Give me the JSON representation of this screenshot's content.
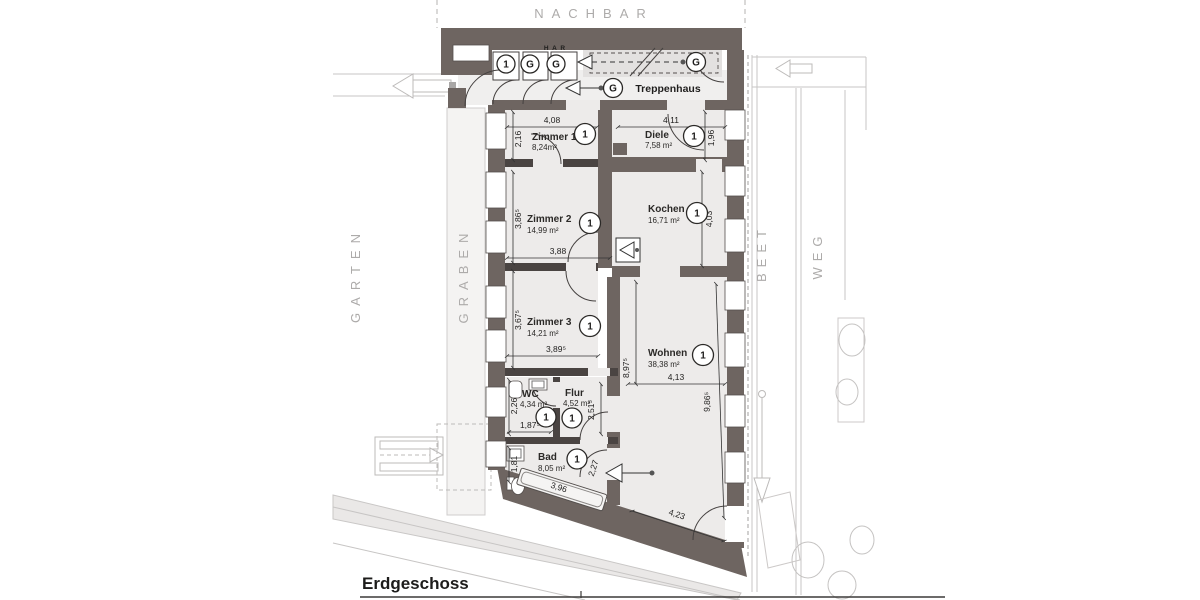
{
  "surroundings": {
    "neighbor_label": "NACHBAR",
    "garden_label": "GARTEN",
    "trench_label": "GRABEN",
    "bed_label": "BEET",
    "path_label": "WEG"
  },
  "plan": {
    "title": "Erdgeschoss",
    "stairwell_label": "Treppenhaus",
    "har_label": "H A R"
  },
  "markers": {
    "closet_1": "1",
    "closet_2": "G",
    "closet_3": "G",
    "hall_arrow": "G",
    "stair_door": "G"
  },
  "rooms": {
    "zimmer1": {
      "name": "Zimmer 1",
      "area": "8,24m²",
      "marker": "1"
    },
    "diele": {
      "name": "Diele",
      "area": "7,58 m²",
      "marker": "1"
    },
    "zimmer2": {
      "name": "Zimmer 2",
      "area": "14,99 m²",
      "marker": "1"
    },
    "kochen": {
      "name": "Kochen",
      "area": "16,71 m²",
      "marker": "1"
    },
    "zimmer3": {
      "name": "Zimmer 3",
      "area": "14,21 m²",
      "marker": "1"
    },
    "wohnen": {
      "name": "Wohnen",
      "area": "38,38 m²",
      "marker": "1"
    },
    "wc": {
      "name": "WC",
      "area": "4,34 m²",
      "marker": "1"
    },
    "flur": {
      "name": "Flur",
      "area": "4,52 m²",
      "marker": "1"
    },
    "bad": {
      "name": "Bad",
      "area": "8,05 m²",
      "marker": "1"
    }
  },
  "dimensions": {
    "zimmer1_width": "4,08",
    "diele_width": "4,11",
    "zimmer1_depth": "2,16",
    "diele_depth": "1,96",
    "zimmer2_depth": "3,86⁵",
    "kochen_depth": "4,03",
    "zimmer2_width": "3,88",
    "zimmer3_depth": "3,67⁵",
    "zimmer3_width": "3,89⁵",
    "wohnen_depth_inner": "8,97⁵",
    "wohnen_width": "4,13",
    "wohnen_depth_right": "9,86⁵",
    "wc_depth": "2,26",
    "wc_width": "1,87⁵",
    "flur_depth": "2,51⁵",
    "bad_depth": "1,81",
    "bathtub_width": "3,96",
    "bad_door": "2,27",
    "wohnen_bottom": "4,23"
  },
  "colors": {
    "wall": "#6e6561",
    "room_fill": "#edebea",
    "surroundings_line": "#c7c5c4",
    "label_gray": "#adabaa"
  }
}
